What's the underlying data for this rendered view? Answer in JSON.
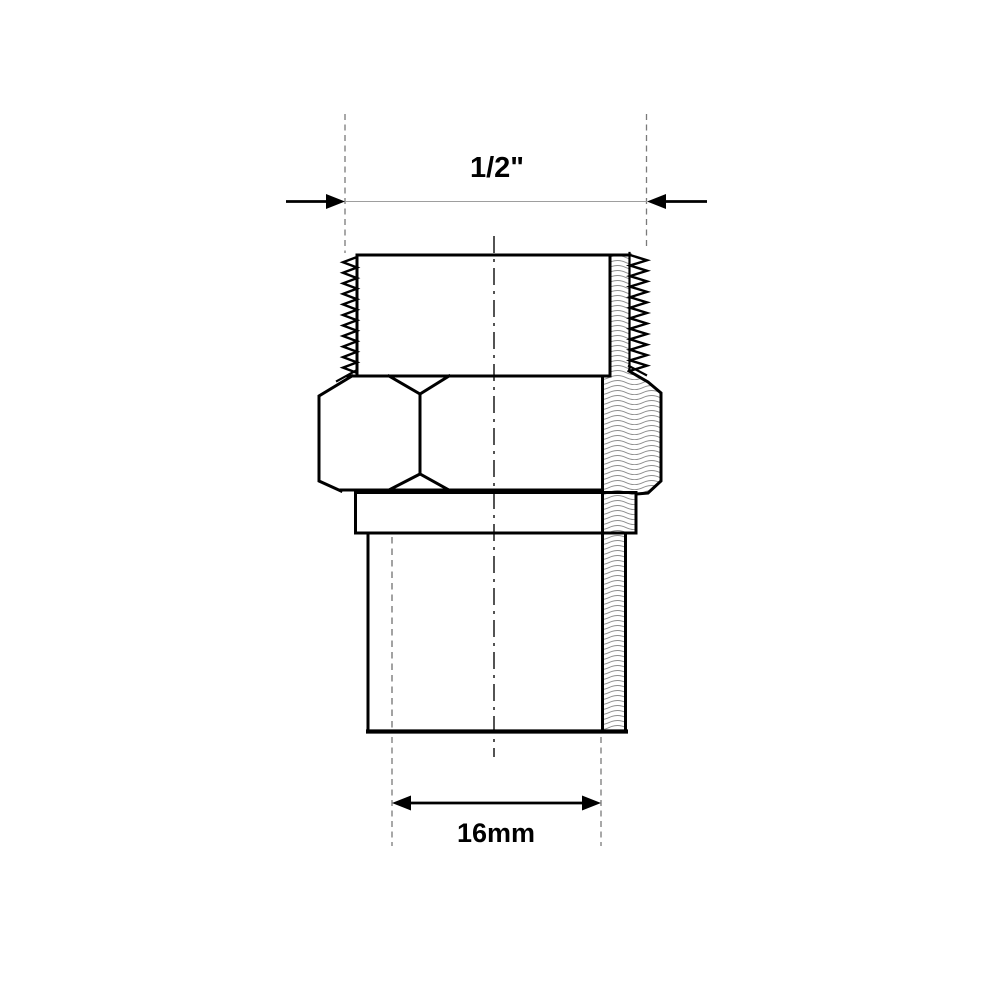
{
  "drawing": {
    "kind": "technical-drawing",
    "dimensions": {
      "top": {
        "label": "1/2\""
      },
      "bottom": {
        "label": "16mm"
      }
    }
  },
  "colors": {
    "background": "#ffffff",
    "line": "#000000",
    "hatch": "#8f8f8f",
    "extension": "#7a7a7a",
    "dimension": "#9e9e9e",
    "centerline": "#1a1a1a"
  }
}
